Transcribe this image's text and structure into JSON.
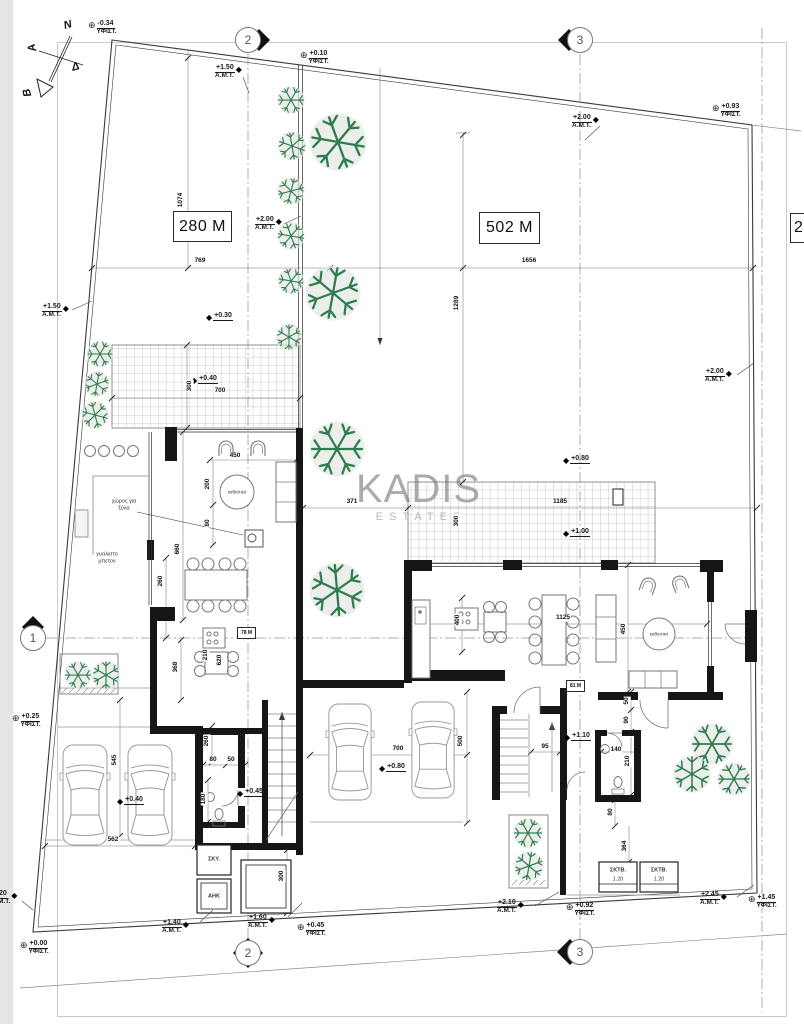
{
  "brand": {
    "name": "KADIS",
    "sub": "ESTATES"
  },
  "compass": {
    "n": "N",
    "a": "A",
    "d": "Δ",
    "b": "B"
  },
  "areas": {
    "left": "280 M",
    "right": "502 M",
    "clipped": "2"
  },
  "tags": {
    "left_unit": "78 M",
    "right_unit": "81 M",
    "stair": "95"
  },
  "grid": {
    "g1": "1",
    "g2": "2",
    "g3": "3"
  },
  "icons": {
    "benchmark": "⊕",
    "level": "◆"
  },
  "rooms": {
    "sit_left": "καθιστικό",
    "sit_right": "καθιστικό",
    "wood": "χώρος για ξύλα",
    "concrete": "γυαλιστο μπετον",
    "dog": "ΣΚΥ.",
    "ahk": "ΑΗΚ",
    "bin": "ΣΚΤΒ.",
    "bin_size": "1.20"
  },
  "markers": {
    "m1": {
      "v": "-0.34",
      "l": "ΥΦΙΣΤ."
    },
    "m2": {
      "v": "+1.50",
      "l": "A.M.T."
    },
    "m3": {
      "v": "+0.10",
      "l": "ΥΦΙΣΤ."
    },
    "m4": {
      "v": "+2.00",
      "l": "A.M.T."
    },
    "m5": {
      "v": "+0.93",
      "l": "ΥΦΙΣΤ."
    },
    "m6": {
      "v": "+2.00",
      "l": "A.M.T."
    },
    "m7": {
      "v": "+1.50",
      "l": "A.M.T."
    },
    "m8": {
      "v": "+0.30"
    },
    "m9": {
      "v": "+0.40"
    },
    "m10": {
      "v": "+2.00",
      "l": "A.M.T."
    },
    "m11": {
      "v": "+0.80"
    },
    "m12": {
      "v": "+1.00"
    },
    "m13": {
      "v": "+0.45"
    },
    "m14": {
      "v": "+0.40"
    },
    "m15": {
      "v": "+0.80"
    },
    "m16": {
      "v": "+1.10"
    },
    "m17": {
      "v": "+0.25",
      "l": "ΥΦΙΣΤ."
    },
    "m18": {
      "v": "+0.00",
      "l": "ΥΦΙΣΤ."
    },
    "m19": {
      "v": "20",
      "l": "M.T."
    },
    "m20": {
      "v": "+1.40",
      "l": "A.M.T."
    },
    "m21": {
      "v": "+1.60",
      "l": "A.M.T."
    },
    "m22": {
      "v": "+0.45",
      "l": "ΥΦΙΣΤ."
    },
    "m23": {
      "v": "+2.10",
      "l": "A.M.T."
    },
    "m24": {
      "v": "+0.92",
      "l": "ΥΦΙΣΤ."
    },
    "m25": {
      "v": "+2.45",
      "l": "A.M.T."
    },
    "m26": {
      "v": "+1.45",
      "l": "ΥΦΙΣΤ."
    }
  },
  "dims": {
    "plot_left_w": "769",
    "plot_right_w": "1656",
    "plot_left_h": "1074",
    "plot_right_h": "1289",
    "perg_left_d": "300",
    "perg_left_w": "700",
    "gap": "371",
    "perg_right_d": "300",
    "perg_right_w": "1185",
    "liv_w": "450",
    "liv_a": "200",
    "liv_b": "80",
    "liv_h": "660",
    "kit_a": "260",
    "kit_b": "210",
    "kit_c": "620",
    "kit_d": "368",
    "gar_h": "545",
    "gar_w": "562",
    "entry": "260",
    "wc_a": "80",
    "wc_b": "50",
    "wc_c": "180",
    "util": "300",
    "court_w": "700",
    "court_h": "500",
    "kitR": "400",
    "dinR": "1125",
    "livR": "450",
    "wingR_a": "50",
    "wingR_b": "90",
    "bathR_w": "140",
    "bathR_h": "210",
    "wingR_c": "80",
    "wingR_d": "364"
  },
  "colors": {
    "line": "#1b1b1b",
    "tree": "#2f7d4e",
    "watermark": "#95959c",
    "grid": "#8a8a8a"
  }
}
